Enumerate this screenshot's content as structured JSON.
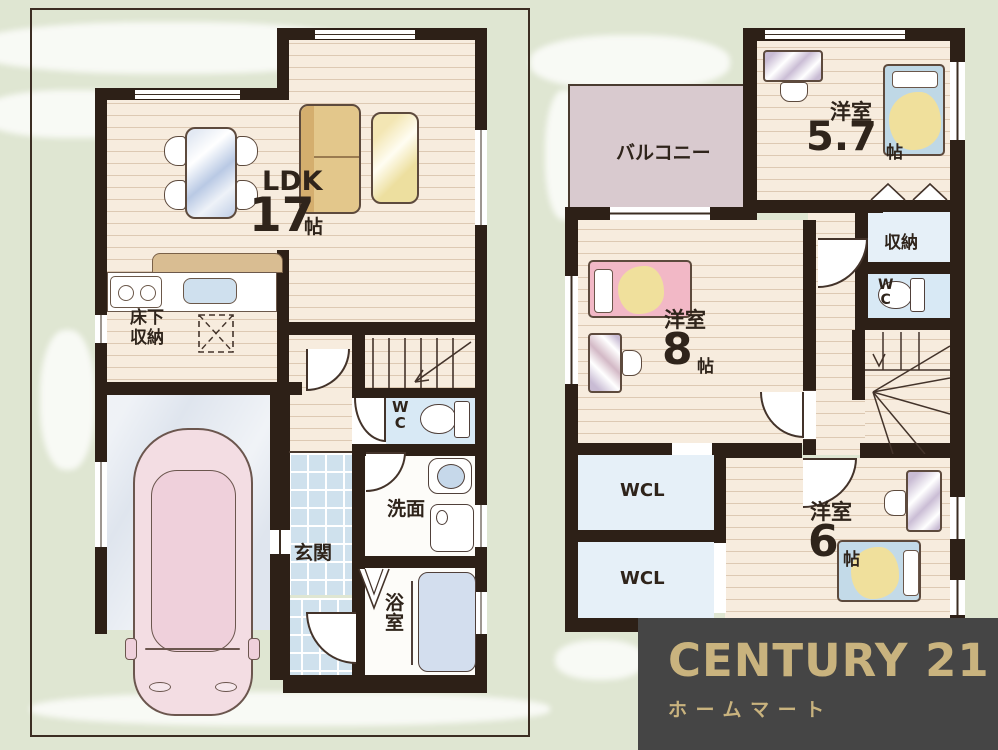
{
  "floor1": {
    "ldk": {
      "name": "LDK",
      "size": "17",
      "unit": "帖"
    },
    "underfloor_storage_line1": "床下",
    "underfloor_storage_line2": "収納",
    "wc": "WC",
    "washroom": "洗面",
    "entrance": "玄関",
    "bathroom": "浴室"
  },
  "floor2": {
    "balcony": "バルコニー",
    "bedroom_57": {
      "name": "洋室",
      "size": "5.7",
      "unit": "帖"
    },
    "storage": "収納",
    "wc": "WC",
    "bedroom_8": {
      "name": "洋室",
      "size": "8",
      "unit": "帖"
    },
    "wcl_1": "WCL",
    "wcl_2": "WCL",
    "bedroom_6": {
      "name": "洋室",
      "size": "6",
      "unit": "帖"
    }
  },
  "logo": {
    "brand": "CENTURY 21",
    "store": "ホームマート"
  },
  "colors": {
    "wall": "#2d2017",
    "floor": "#f7ecde",
    "background": "#dfe6d2",
    "tile": "#cfe1ed",
    "water_blue": "#d8e9f5",
    "balcony": "#d9cacf",
    "logo_background": "#454545",
    "logo_gold": "#c9b37e"
  }
}
